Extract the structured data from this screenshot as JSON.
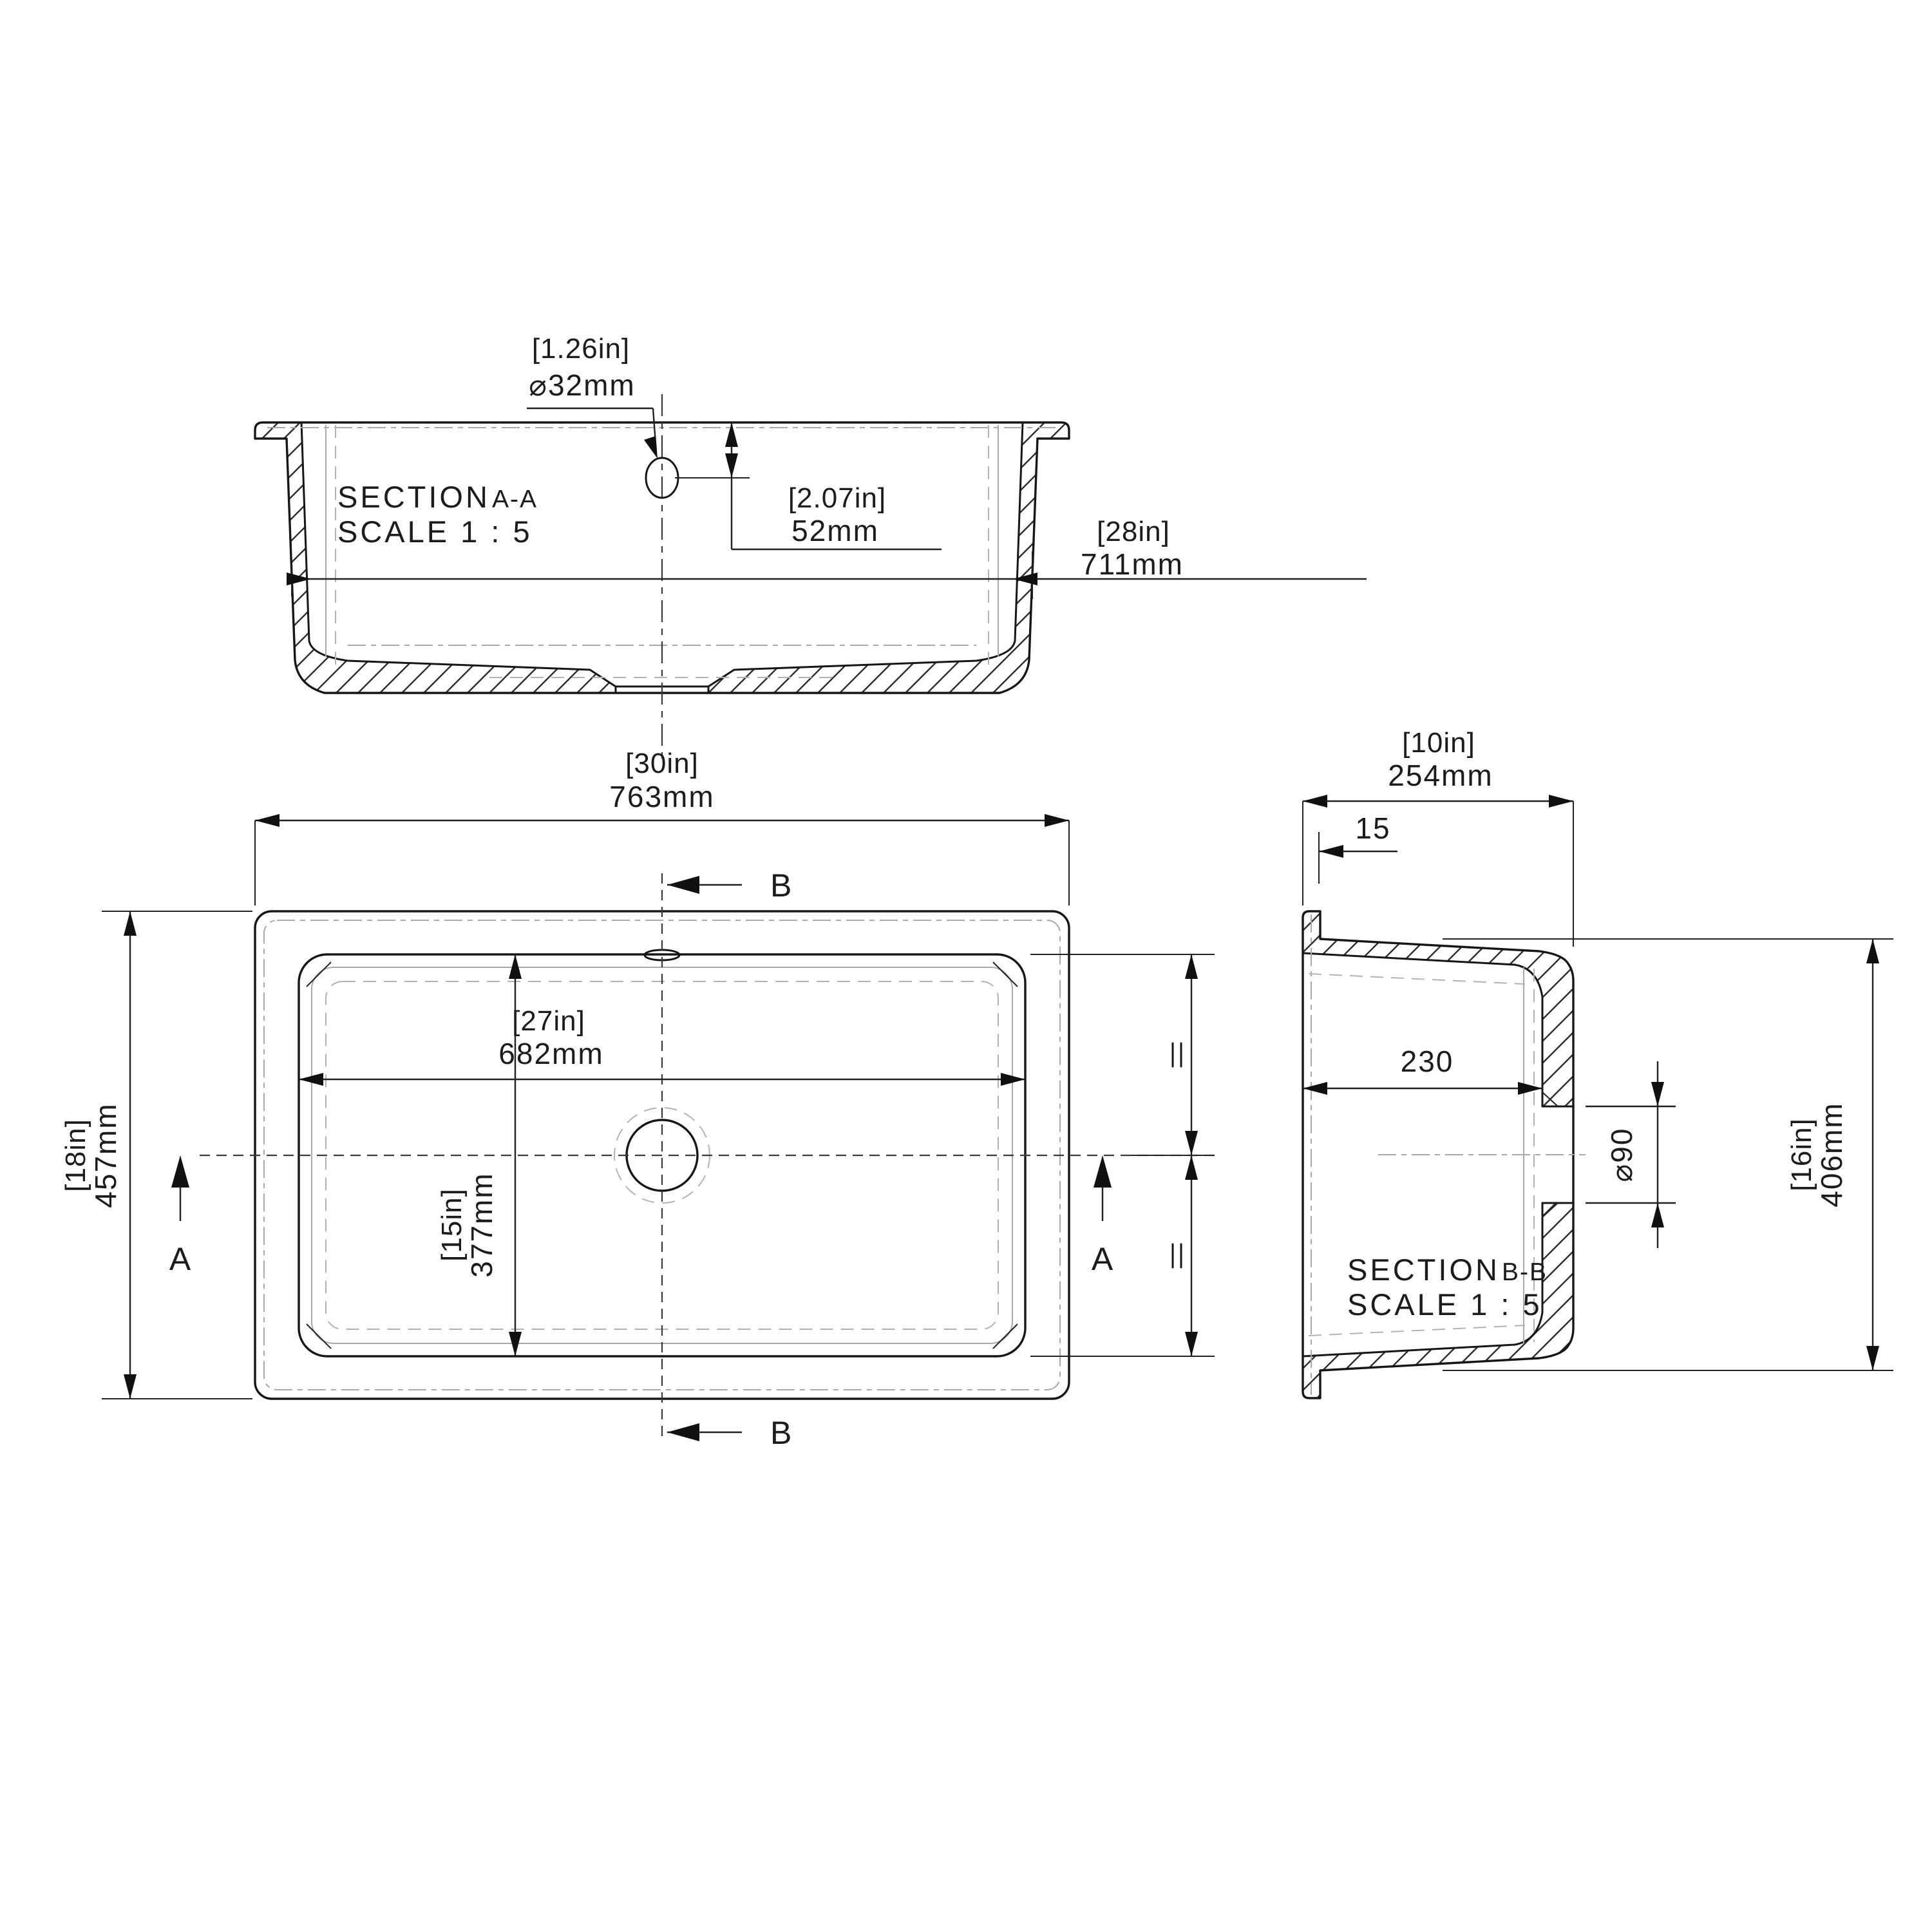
{
  "drawing": {
    "section_aa": {
      "title_prefix": "SECTION",
      "title_suffix": "A-A",
      "scale": "SCALE 1 : 5",
      "drain_dia_bracket": "[1.26in]",
      "drain_dia_mm": "⌀32mm",
      "drain_depth_bracket": "[2.07in]",
      "drain_depth_mm": "52mm",
      "inner_width_bracket": "[28in]",
      "inner_width_mm": "711mm"
    },
    "plan": {
      "overall_width_bracket": "[30in]",
      "overall_width_mm": "763mm",
      "overall_depth_bracket": "[18in]",
      "overall_depth_mm": "457mm",
      "bowl_width_bracket": "[27in]",
      "bowl_width_mm": "682mm",
      "bowl_depth_bracket": "[15in]",
      "bowl_depth_mm": "377mm",
      "cut_label_a": "A",
      "cut_label_b": "B"
    },
    "section_bb": {
      "title_prefix": "SECTION",
      "title_suffix": "B-B",
      "scale": "SCALE 1 : 5",
      "overall_depth_bracket": "[10in]",
      "overall_depth_mm": "254mm",
      "rim_thickness": "15",
      "bowl_depth": "230",
      "drain_dia": "⌀90",
      "bowl_span_bracket": "[16in]",
      "bowl_span_mm": "406mm"
    }
  }
}
